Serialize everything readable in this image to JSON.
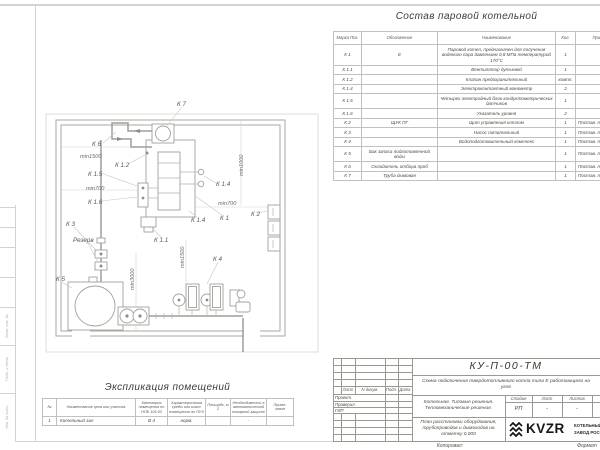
{
  "parts_table": {
    "title": "Состав паровой котельной",
    "headers": [
      "Марка Поз.",
      "Обозначение",
      "Наименование",
      "Кол.",
      "Примечание"
    ],
    "rows": [
      {
        "mark": "К 1",
        "designation": "Е",
        "name": "Паровой котел, предназначен для получения водяного пара давлением 0,8 МПа температурой 170°С",
        "qty": "1",
        "note": ""
      },
      {
        "mark": "К 1.1",
        "designation": "",
        "name": "Вентилятор дутьевой",
        "qty": "1",
        "note": ""
      },
      {
        "mark": "К 1.2",
        "designation": "",
        "name": "Клапан предохранительный",
        "qty": "компл.",
        "note": ""
      },
      {
        "mark": "К 1.4",
        "designation": "",
        "name": "Электроконтактный манометр",
        "qty": "2",
        "note": ""
      },
      {
        "mark": "К 1.5",
        "designation": "",
        "name": "Четырех электродный блок кондуктометрических датчиков",
        "qty": "1",
        "note": ""
      },
      {
        "mark": "К 1.6",
        "designation": "",
        "name": "Указатель уровня",
        "qty": "2",
        "note": ""
      },
      {
        "mark": "К 2",
        "designation": "ЩУК ПГ",
        "name": "Щит управления котлом",
        "qty": "1",
        "note": "Постав. по соглас."
      },
      {
        "mark": "К 3",
        "designation": "",
        "name": "Насос питательный",
        "qty": "1",
        "note": "Постав. по соглас."
      },
      {
        "mark": "К 4",
        "designation": "",
        "name": "Водоподготовительный комплекс",
        "qty": "1",
        "note": "Постав. по соглас."
      },
      {
        "mark": "К 5",
        "designation": "Бак запаса подготовленной воды",
        "name": "",
        "qty": "1",
        "note": "Постав. по соглас."
      },
      {
        "mark": "К 6",
        "designation": "Охладитель отбора проб",
        "name": "",
        "qty": "1",
        "note": "Постав. по соглас."
      },
      {
        "mark": "К 7",
        "designation": "Труба дымовая",
        "name": "",
        "qty": "1",
        "note": "Постав. по соглас."
      }
    ]
  },
  "room_table": {
    "title": "Экспликация помещений",
    "headers": [
      "№",
      "Наименование цеха или участка",
      "Категория помещения по НПБ 105-03",
      "Характеристика среды или класс помещения по ПУЭ",
      "Площадь, м 2",
      "Необходимость в автоматической пожарной защите",
      "Приме- чание"
    ],
    "rows": [
      [
        "1",
        "Котельный зал",
        "В 4",
        "норм.",
        "",
        "-",
        ""
      ]
    ]
  },
  "plan": {
    "labels": [
      {
        "text": "К 7",
        "x": 177,
        "y": 106
      },
      {
        "text": "К 6",
        "x": 92,
        "y": 146
      },
      {
        "text": "min1500",
        "x": 80,
        "y": 158,
        "cls": "pdim"
      },
      {
        "text": "К 1.2",
        "x": 115,
        "y": 167
      },
      {
        "text": "К 1.5",
        "x": 88,
        "y": 176
      },
      {
        "text": "min700",
        "x": 86,
        "y": 190,
        "cls": "pdim"
      },
      {
        "text": "К 1.6",
        "x": 88,
        "y": 204
      },
      {
        "text": "min1000",
        "x": 243,
        "y": 176,
        "rot": -90,
        "cls": "pdim"
      },
      {
        "text": "К 1.4",
        "x": 216,
        "y": 186
      },
      {
        "text": "min700",
        "x": 218,
        "y": 205,
        "cls": "pdim"
      },
      {
        "text": "К 1.4",
        "x": 191,
        "y": 222
      },
      {
        "text": "К 1",
        "x": 220,
        "y": 220
      },
      {
        "text": "К 2",
        "x": 251,
        "y": 216
      },
      {
        "text": "К 3",
        "x": 66,
        "y": 226
      },
      {
        "text": "Резерв",
        "x": 73,
        "y": 242
      },
      {
        "text": "К 1.1",
        "x": 154,
        "y": 242
      },
      {
        "text": "min1500",
        "x": 184,
        "y": 268,
        "rot": -90,
        "cls": "pdim"
      },
      {
        "text": "min3000",
        "x": 134,
        "y": 290,
        "rot": -90,
        "cls": "pdim"
      },
      {
        "text": "К 5",
        "x": 56,
        "y": 281
      },
      {
        "text": "К 4",
        "x": 213,
        "y": 261
      }
    ]
  },
  "title_block": {
    "doc_number": "КУ-П-00-ТМ",
    "subtitle": "Схема подключения твердотопливного котла типа Е работающего на угле",
    "object_line1": "Котельная. Типовые решения.",
    "object_line2": "Тепломеханические решения.",
    "sheet_name": "План расстановки оборудования, трубопроводов и дымоходов на отметку 0,000",
    "col_headers": [
      "Лист",
      "N докум.",
      "Подп.",
      "Дата"
    ],
    "roles": [
      "Проект.",
      "Проверил",
      "ГИП"
    ],
    "stage_label": "Стадия",
    "sheet_label": "Лист",
    "sheets_label": "Листов",
    "stage_value": "РП",
    "sheet_value": "-",
    "sheets_value": "-",
    "logo_text": "KVZR",
    "company_line1": "КОТЕЛЬНЫЙ",
    "company_line2": "ЗАВОД РОССИИ",
    "copy_label": "Копировал:",
    "format_label": "Формат"
  },
  "frame": {
    "stamp_labels": [
      "Взам. инв. №",
      "Подп. и дата",
      "Инв. № подл."
    ]
  }
}
